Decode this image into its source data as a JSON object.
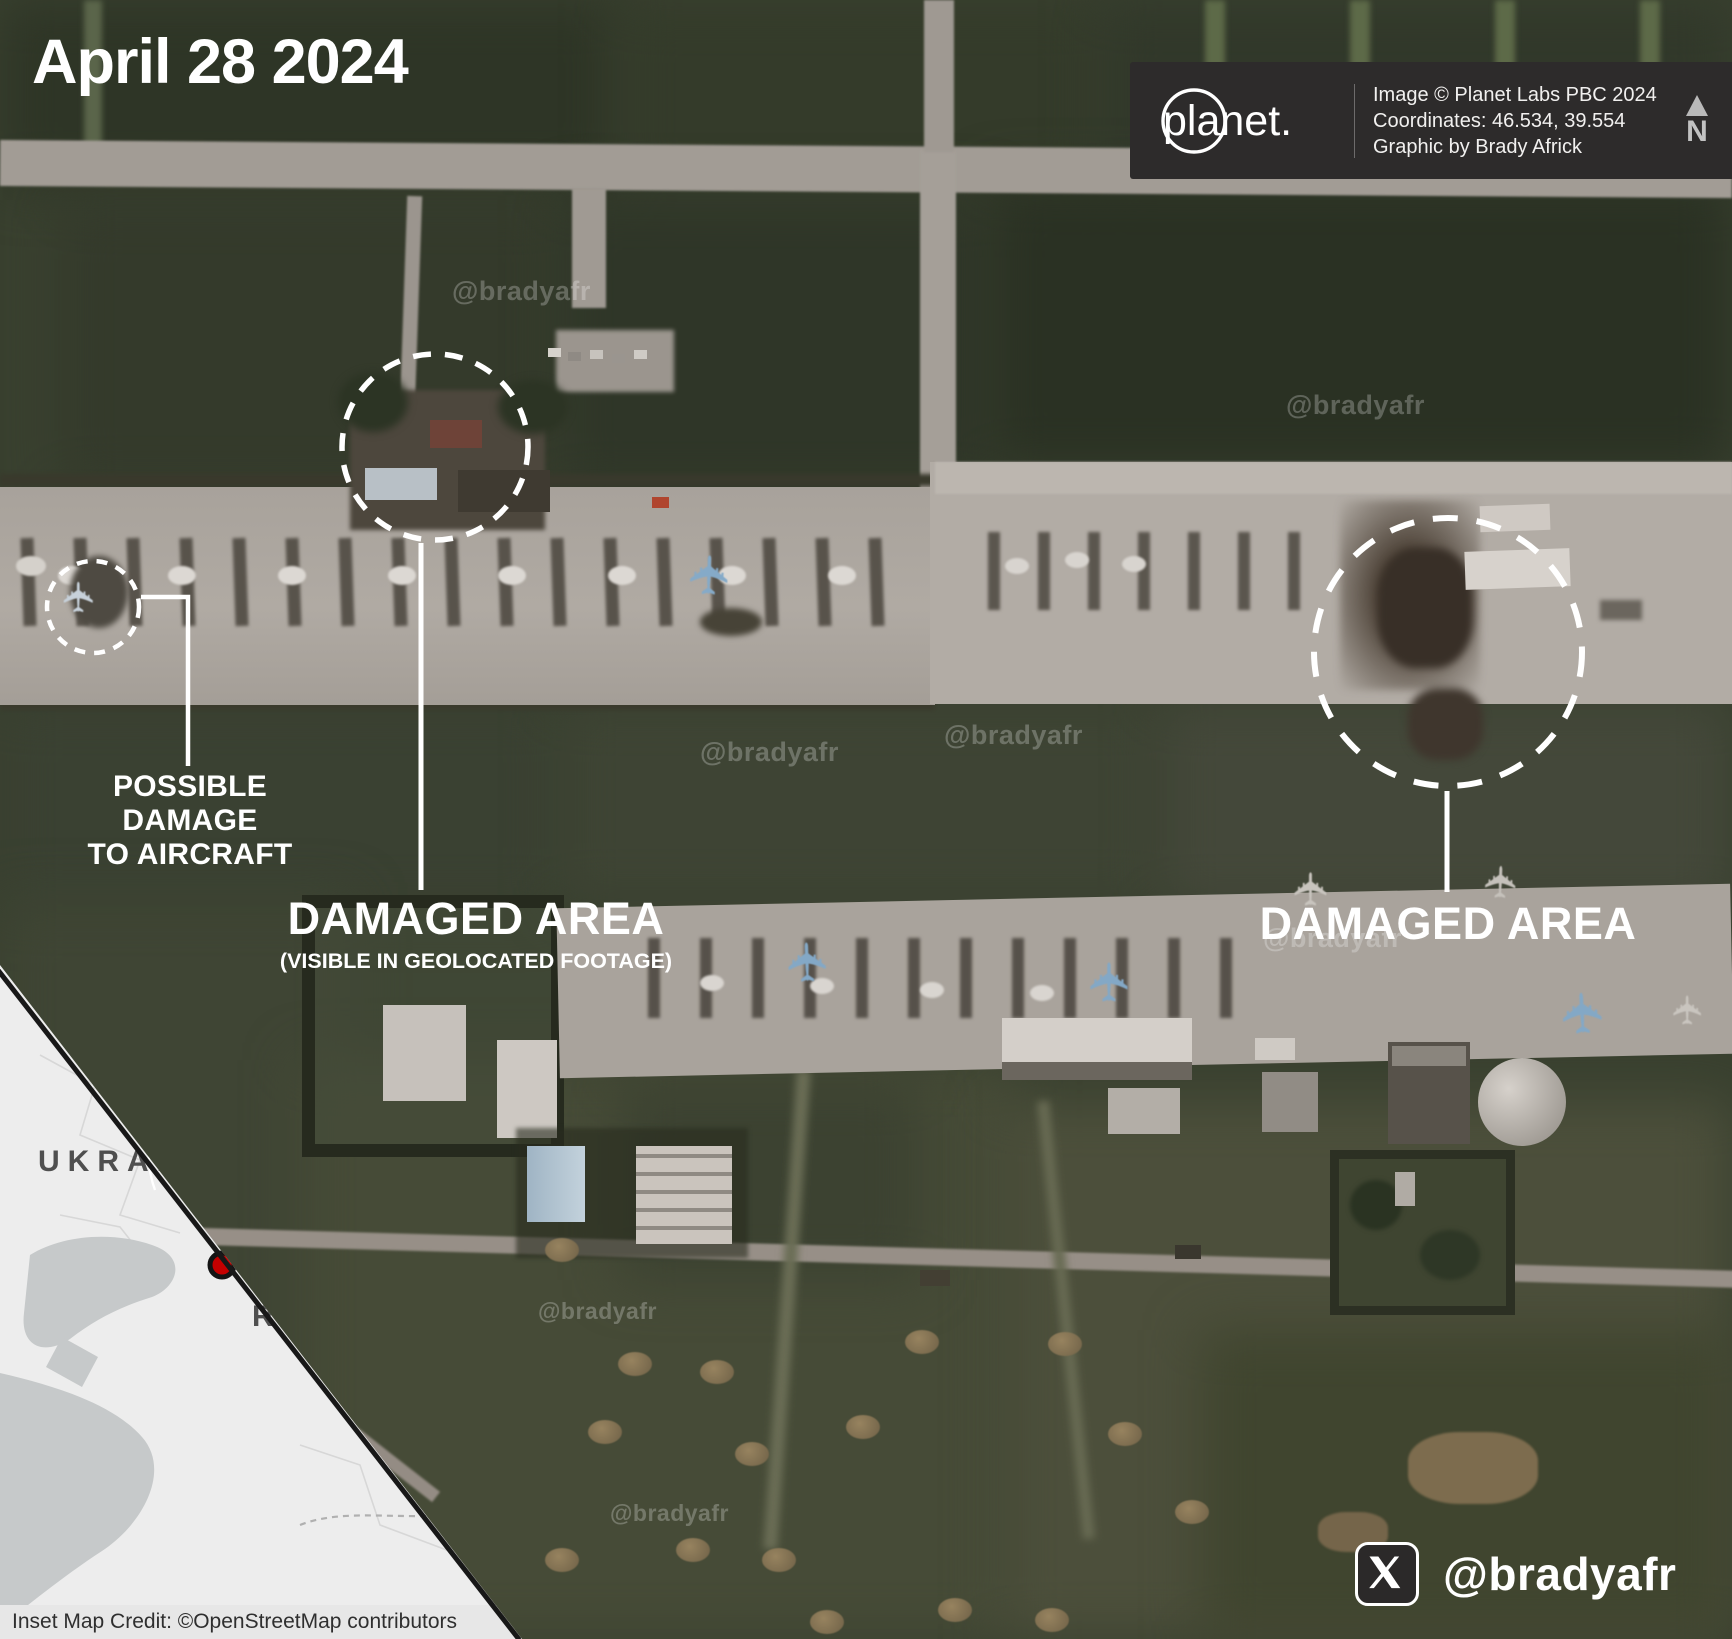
{
  "title": "April 28 2024",
  "credit_box": {
    "logo": "planet.",
    "lines": [
      "Image © Planet Labs PBC 2024",
      "Coordinates: 46.534, 39.554",
      "Graphic by Brady Africk"
    ],
    "north": "N"
  },
  "annotations": {
    "aircraft": {
      "line1": "POSSIBLE DAMAGE",
      "line2": "TO AIRCRAFT"
    },
    "left_area": {
      "title": "DAMAGED AREA",
      "subtitle": "(VISIBLE IN GEOLOCATED FOOTAGE)"
    },
    "right_area": {
      "title": "DAMAGED AREA"
    }
  },
  "inset_map": {
    "country_top": "UKRAINE",
    "country_bottom": "RUSSIA",
    "credit": "Inset Map Credit: ©OpenStreetMap contributors"
  },
  "social": {
    "handle": "@bradyafr"
  },
  "watermark": "@bradyafr",
  "colors": {
    "annotation": "#ffffff",
    "marker_red": "#c40000",
    "credit_box_bg": "#2d2b2b",
    "map_land": "#ededed",
    "map_sea": "#c6c9ca"
  }
}
